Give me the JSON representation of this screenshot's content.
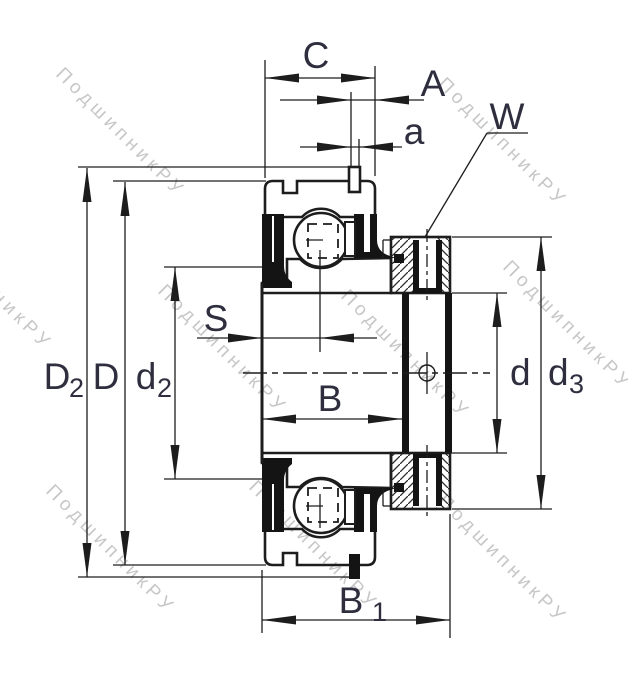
{
  "watermark": {
    "text": "ПодшипникРУ",
    "color": "#c7c7c7"
  },
  "colors": {
    "line": "#1d1d1d",
    "label": "#2e2e3e",
    "seal": "#141414",
    "background": "#ffffff"
  },
  "dimensions": {
    "C": "C",
    "A": "A",
    "a": "a",
    "W": "W",
    "S": "S",
    "B": "B",
    "D": "D",
    "d": "d",
    "B1": {
      "main": "B",
      "sub": "1"
    },
    "D2": {
      "main": "D",
      "sub": "2"
    },
    "d2": {
      "main": "d",
      "sub": "2"
    },
    "d3": {
      "main": "d",
      "sub": "3"
    }
  }
}
